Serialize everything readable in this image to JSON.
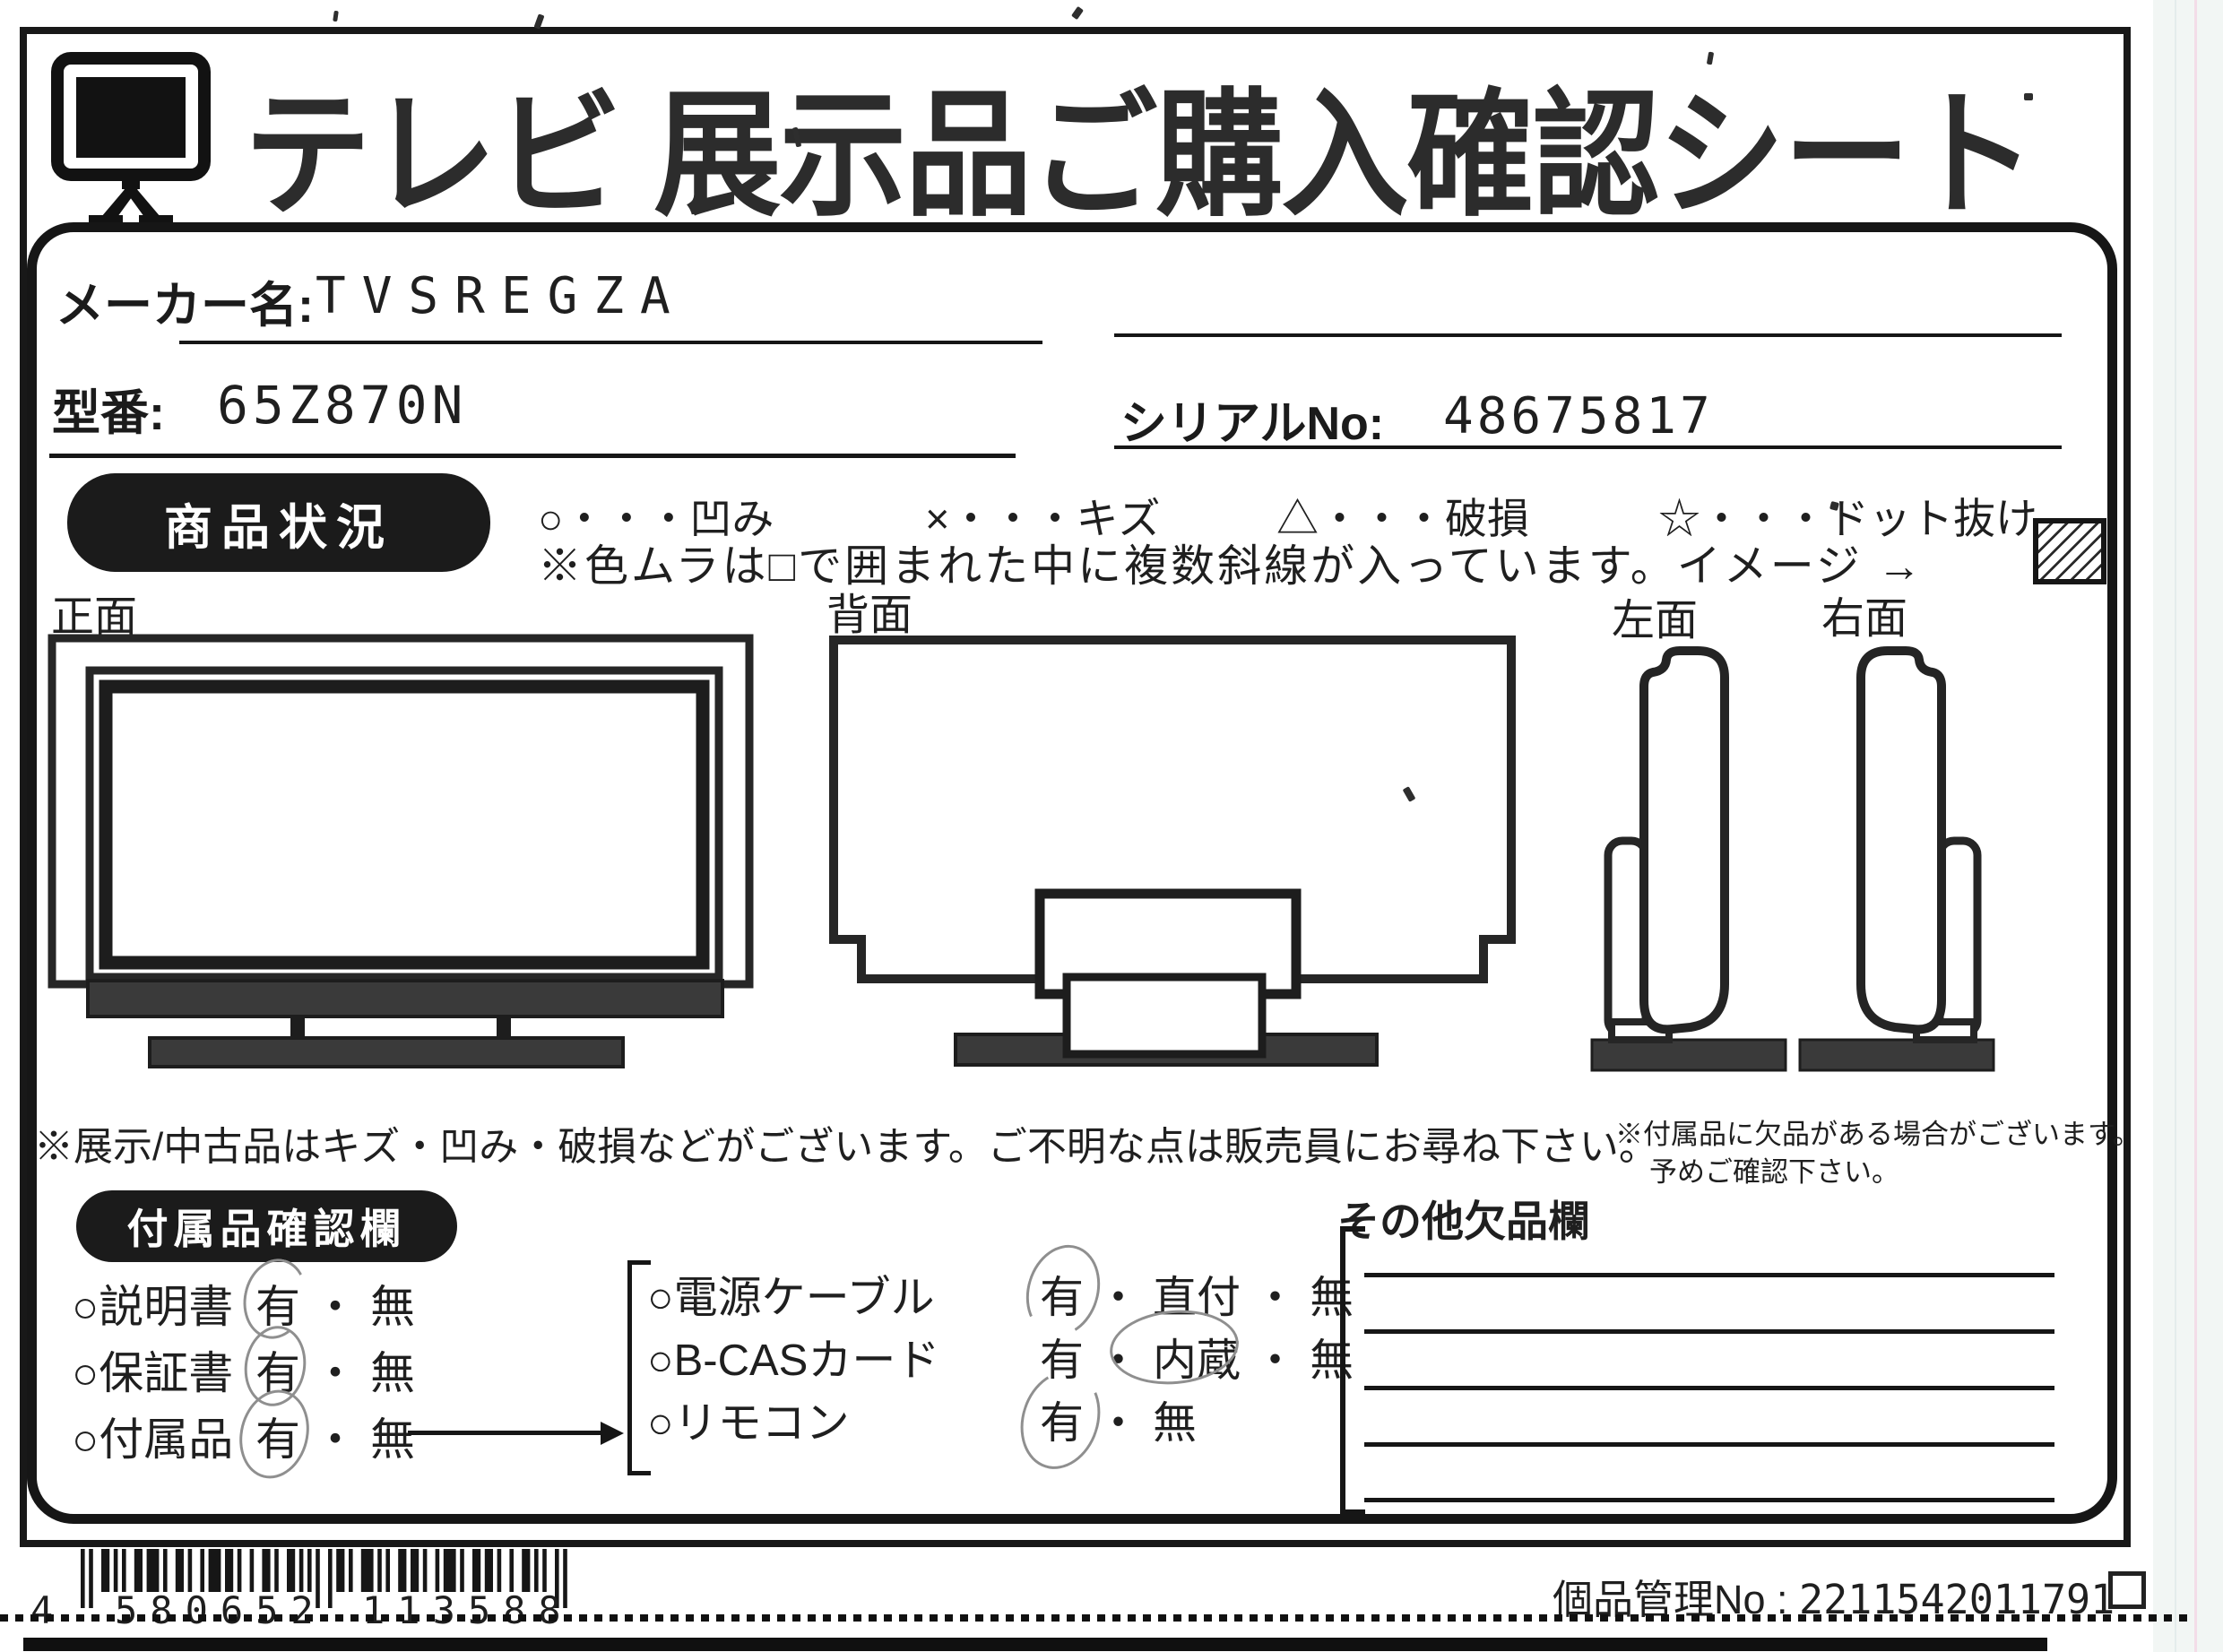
{
  "header": {
    "title": "テレビ 展示品ご購入確認シート",
    "tv_icon": "tv-icon"
  },
  "fields": {
    "maker_label": "メーカー名:",
    "maker_value": "TVSREGZA",
    "model_label": "型番:",
    "model_value": "65Z870N",
    "serial_label": "シリアルNo:",
    "serial_value": "48675817"
  },
  "condition": {
    "badge": "商品状況",
    "legend_separator": "・・・",
    "legend": [
      {
        "symbol": "○",
        "meaning": "凹み"
      },
      {
        "symbol": "×",
        "meaning": "キズ"
      },
      {
        "symbol": "△",
        "meaning": "破損"
      },
      {
        "symbol": "☆",
        "meaning": "ドット抜け"
      }
    ],
    "note": "※色ムラは□で囲まれた中に複数斜線が入っています。イメージ →"
  },
  "views": {
    "front": "正面",
    "back": "背面",
    "left": "左面",
    "right": "右面"
  },
  "notes": {
    "main": "※展示/中古品はキズ・凹み・破損などがございます。ご不明な点は販売員にお尋ね下さい。",
    "accessory_line1": "※付属品に欠品がある場合がございます。",
    "accessory_line2": "予めご確認下さい。"
  },
  "accessories": {
    "badge": "付属品確認欄",
    "separator": "・",
    "left_items": [
      {
        "name": "○説明書",
        "options": [
          "有",
          "無"
        ],
        "selected": "有"
      },
      {
        "name": "○保証書",
        "options": [
          "有",
          "無"
        ],
        "selected": "有"
      },
      {
        "name": "○付属品",
        "options": [
          "有",
          "無"
        ],
        "selected": "有"
      }
    ],
    "right_items": [
      {
        "name": "○電源ケーブル",
        "options": [
          "有",
          "直付",
          "無"
        ],
        "selected": "有"
      },
      {
        "name": "○B-CASカード",
        "options": [
          "有",
          "内蔵",
          "無"
        ],
        "selected": "内蔵"
      },
      {
        "name": "○リモコン",
        "options": [
          "有",
          "無"
        ],
        "selected": "有"
      }
    ]
  },
  "missing_section": {
    "title": "その他欠品欄",
    "line_count": 5
  },
  "footer": {
    "barcode": {
      "first": "4",
      "group1": "580652",
      "group2": "113588"
    },
    "management_label": "個品管理No : ",
    "management_number": "2211542011791"
  },
  "colors": {
    "ink": "#1f1f1f",
    "paper": "#ffffff",
    "dark_fill": "#3a3a3a",
    "pencil": "#8f8f8f"
  }
}
